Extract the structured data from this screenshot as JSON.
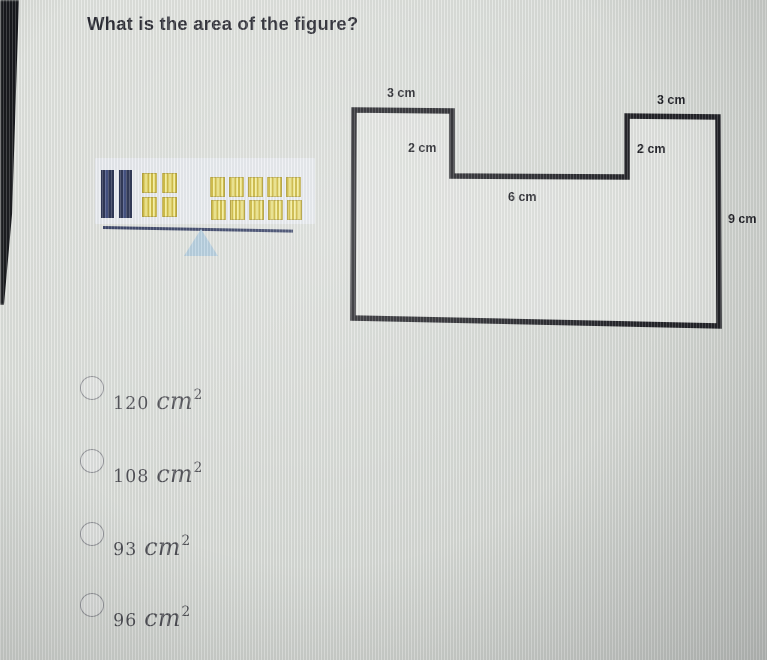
{
  "question": {
    "title": "What is the area of the figure?"
  },
  "figure": {
    "type": "rectilinear-polygon-with-top-notch",
    "outline_color": "#17171d",
    "labels": {
      "top_left": "3 cm",
      "top_right": "3 cm",
      "notch_left": "2 cm",
      "notch_right": "2 cm",
      "notch_bottom": "6 cm",
      "right_side": "9 cm"
    }
  },
  "illustration": {
    "name": "balance-scale-with-base-ten-blocks",
    "left_rods": 2,
    "left_squares": 4,
    "right_squares": 10,
    "rod_color": "#141d41",
    "square_color": "#e0c93c",
    "beam_color": "#242f58",
    "fulcrum_color": "#a6c6dc"
  },
  "options": [
    {
      "value": "120",
      "unit": "cm",
      "exponent": "2"
    },
    {
      "value": "108",
      "unit": "cm",
      "exponent": "2"
    },
    {
      "value": "93",
      "unit": "cm",
      "exponent": "2"
    },
    {
      "value": "96",
      "unit": "cm",
      "exponent": "2"
    }
  ]
}
